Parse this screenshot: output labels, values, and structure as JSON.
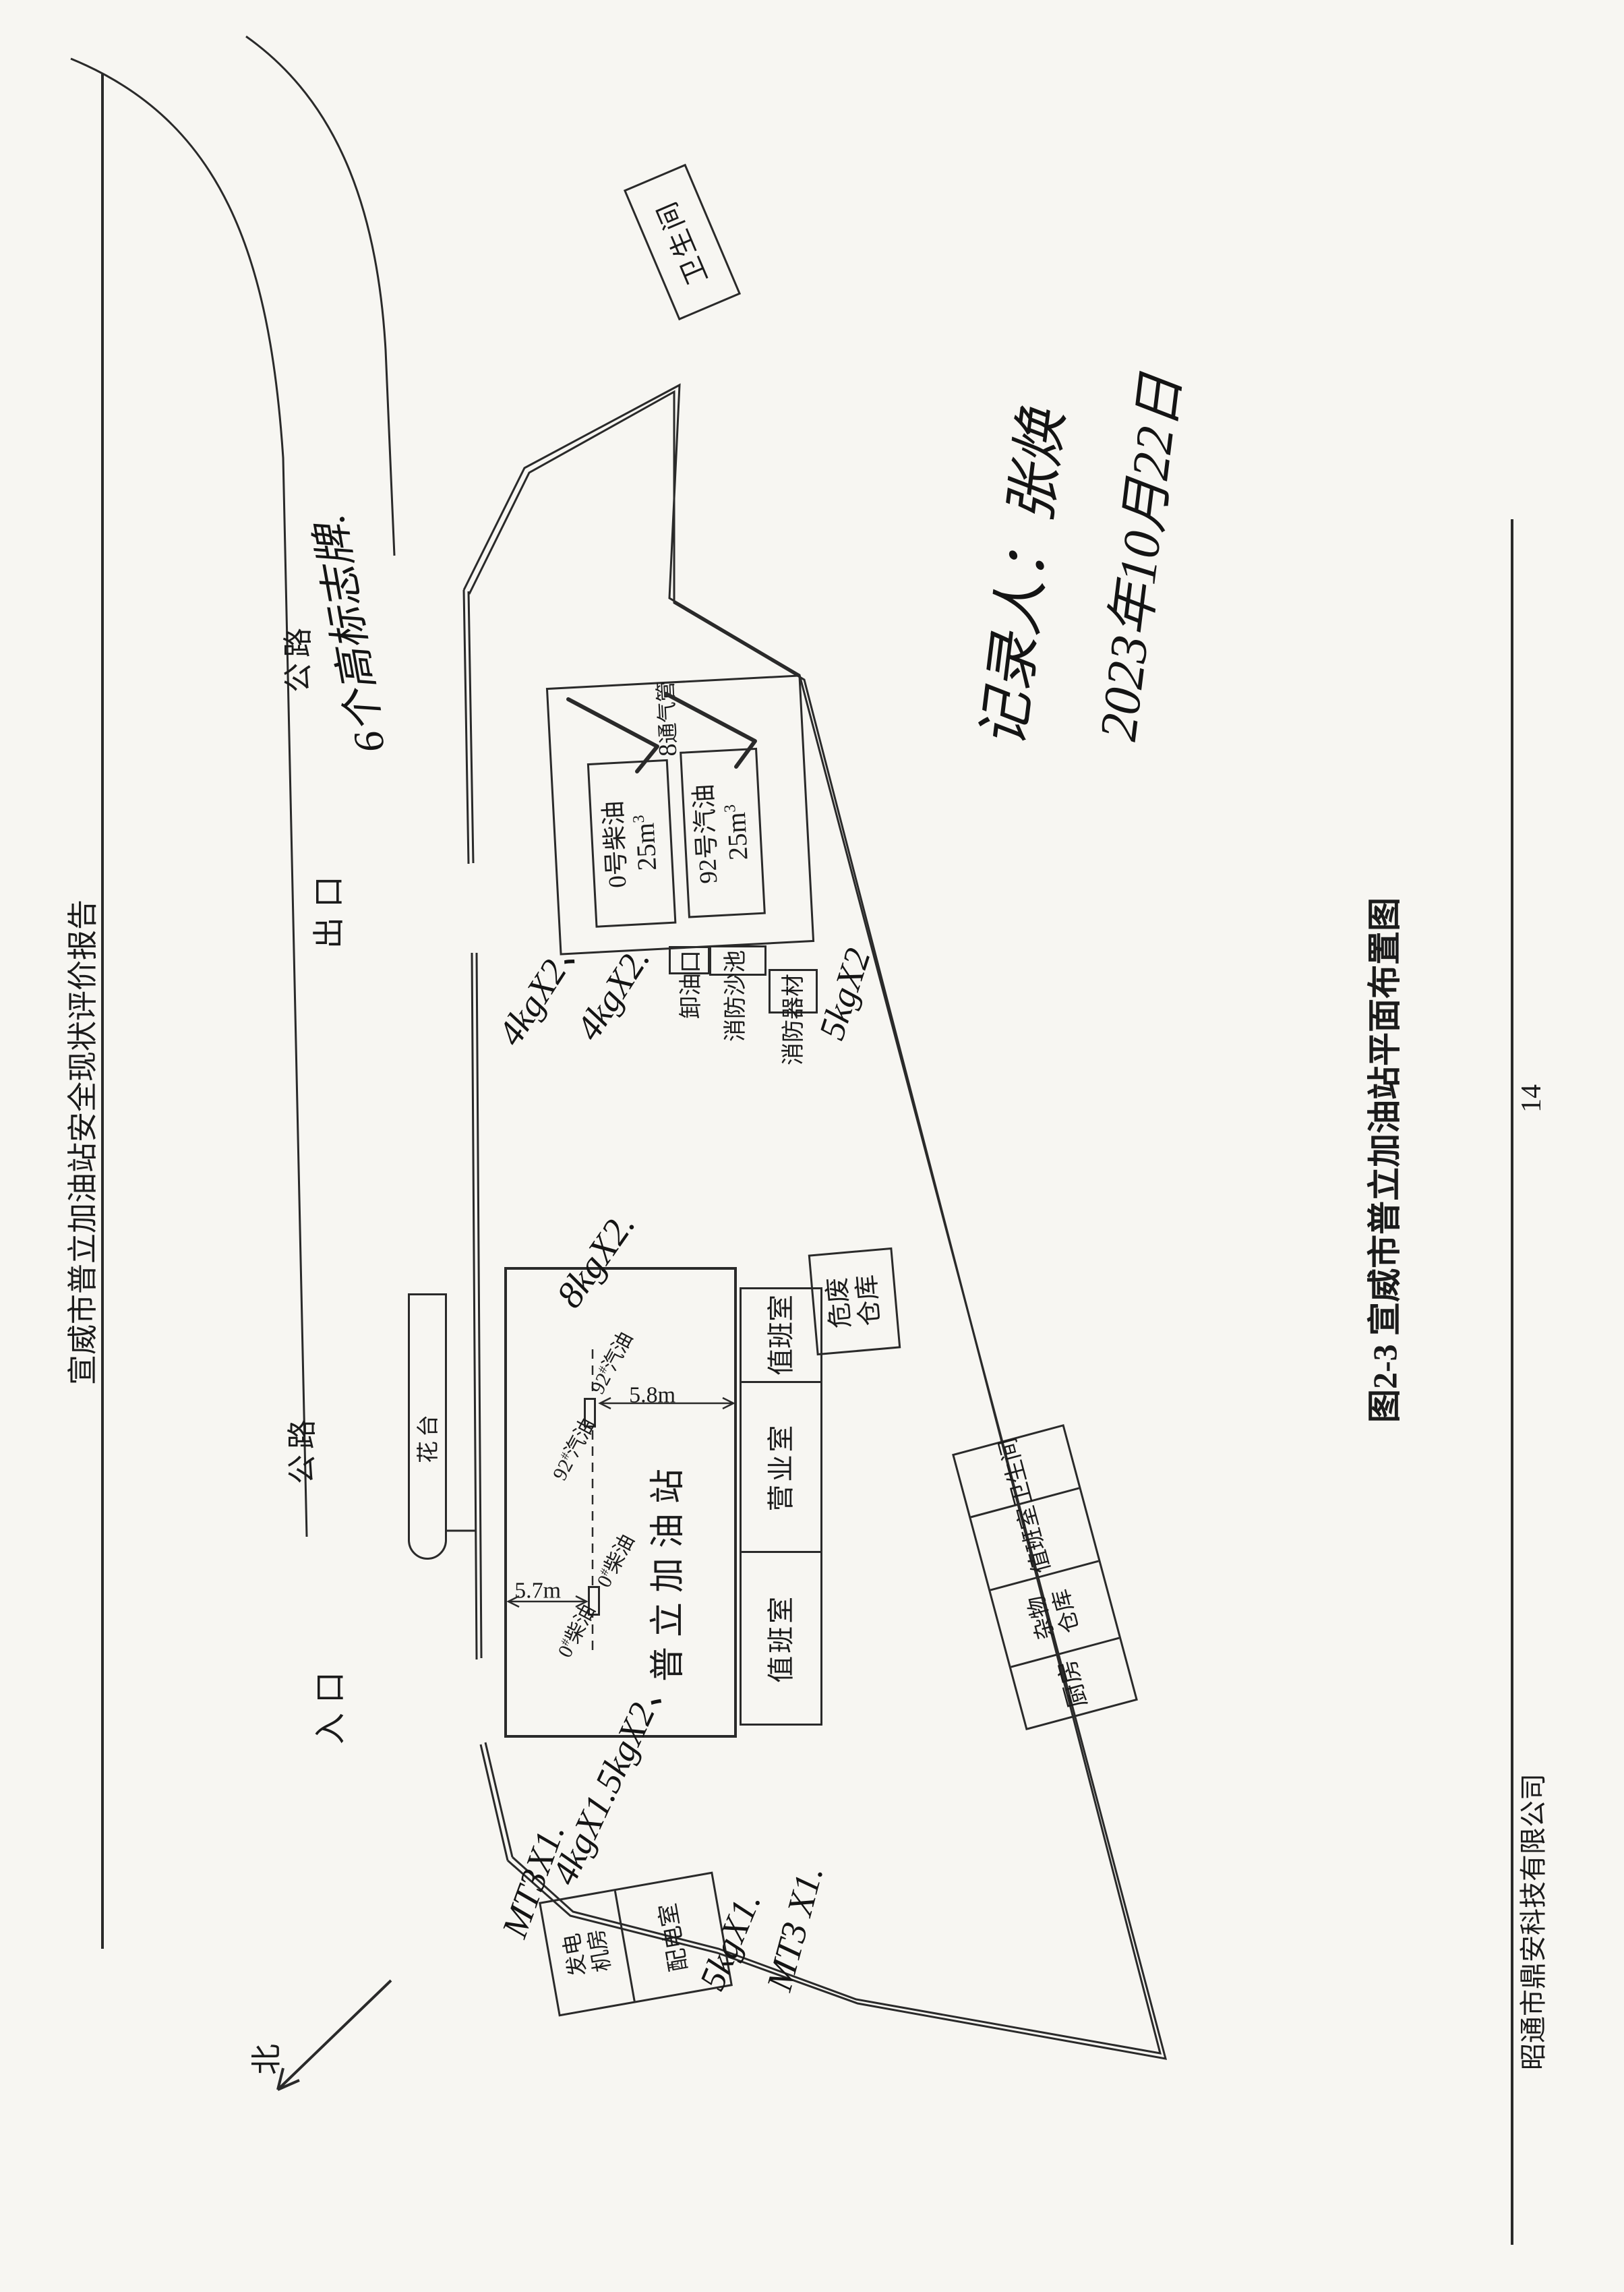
{
  "page": {
    "header_title": "宣威市普立加油站安全现状评价报告",
    "figure_caption": "图2-3  宣威市普立加油站平面布置图",
    "page_number": "14",
    "footer_company": "昭通市鼎安科技有限公司",
    "ink_color": "#2a2a2a",
    "paper_color": "#f7f6f2"
  },
  "roads": {
    "road_label_a": "公路",
    "road_label_b": "公路",
    "exit_label": "出口",
    "entrance_label": "入口",
    "north_label": "北"
  },
  "site": {
    "toilet_top": "卫生间",
    "flower_bed": "花台",
    "station_name": "普立加油站",
    "duty_room_left": "值班室",
    "business_room": "营业室",
    "duty_room_right": "值班室",
    "hazard_line1": "危废",
    "hazard_line2": "仓库",
    "south_row": {
      "kitchen": "厨房",
      "sundry_line1": "杂物",
      "sundry_line2": "仓库",
      "duty": "值班室",
      "toilet": "卫生间"
    },
    "power": {
      "gen_line1": "发电",
      "gen_line2": "机房",
      "dist": "配电室"
    }
  },
  "tank_area": {
    "tank1_name": "0号柴油",
    "tank1_cap": "25m",
    "tank1_sup": "3",
    "tank2_name": "92号汽油",
    "tank2_cap": "25m",
    "tank2_sup": "3",
    "vent_symbol": "8",
    "vent_label": "通气管",
    "unload_label": "卸油口",
    "sand_label": "消防沙池",
    "equip_label": "消防器材"
  },
  "dispensers": {
    "d1_num": "0",
    "d1_hash": "#",
    "d1_fuel": "柴油",
    "d2_num": "92",
    "d2_hash": "#",
    "d2_fuel": "汽油",
    "dim_left": "5.7m",
    "dim_right": "5.8m"
  },
  "handwriting": {
    "signs_note": "6个高标志牌.",
    "canopy_ext": "8kgX2.",
    "unload_ext1": "4kgX2、",
    "unload_ext2": "4kgX2.",
    "equip_ext": "5kgX2",
    "power_ext1": "MT3X1.",
    "power_ext2": "4kgX1.5kgX2、",
    "power_ext3": "5kgX1.",
    "power_ext4": "MT3 X1.",
    "recorder": "记录人：张焕",
    "date": "2023年10月22日"
  }
}
